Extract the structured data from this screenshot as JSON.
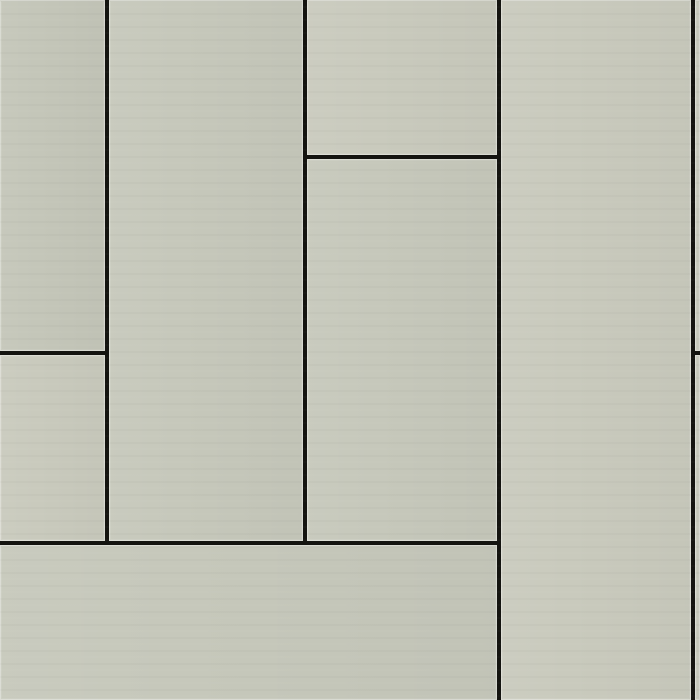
{
  "meta": {
    "description": "Seamless texture of smooth grey-green fiber-cement facade cladding planks laid vertically in a staggered running-bond pattern with thin dark open joints",
    "width": 700,
    "height": 700
  },
  "palette": {
    "seam": "#141410",
    "edge_highlight": "#d9dbd0",
    "panel_a": "#c4c6b9",
    "panel_b": "#c6c8bb",
    "panel_c": "#c9cabd"
  },
  "texture": {
    "seam_thickness": 4,
    "panels": [
      {
        "id": "panel-left-top",
        "x": 0,
        "y": 0,
        "w": 105,
        "h": 351,
        "shade": "panel_a"
      },
      {
        "id": "panel-left-lower",
        "x": 0,
        "y": 355,
        "w": 105,
        "h": 186,
        "shade": "panel_c"
      },
      {
        "id": "panel-col2-full",
        "x": 109,
        "y": 0,
        "w": 194,
        "h": 541,
        "shade": "panel_b"
      },
      {
        "id": "panel-col3-top",
        "x": 307,
        "y": 0,
        "w": 190,
        "h": 155,
        "shade": "panel_c"
      },
      {
        "id": "panel-col3-middle",
        "x": 307,
        "y": 159,
        "w": 190,
        "h": 382,
        "shade": "panel_b"
      },
      {
        "id": "panel-col4-full-height",
        "x": 501,
        "y": 0,
        "w": 190,
        "h": 700,
        "shade": "panel_c"
      },
      {
        "id": "panel-right-strip-top",
        "x": 695,
        "y": 0,
        "w": 5,
        "h": 351,
        "shade": "panel_b"
      },
      {
        "id": "panel-right-strip-lower",
        "x": 695,
        "y": 355,
        "w": 5,
        "h": 345,
        "shade": "panel_b"
      },
      {
        "id": "panel-bottom-wide",
        "x": 0,
        "y": 545,
        "w": 497,
        "h": 155,
        "shade": "panel_b"
      }
    ],
    "seams": [
      {
        "id": "seam-vertical-1",
        "orientation": "vertical",
        "x": 105,
        "y": 0,
        "length": 545
      },
      {
        "id": "seam-vertical-2",
        "orientation": "vertical",
        "x": 303,
        "y": 0,
        "length": 545
      },
      {
        "id": "seam-vertical-3",
        "orientation": "vertical",
        "x": 497,
        "y": 0,
        "length": 700
      },
      {
        "id": "seam-vertical-4",
        "orientation": "vertical",
        "x": 691,
        "y": 0,
        "length": 700
      },
      {
        "id": "seam-horizontal-col3",
        "orientation": "horizontal",
        "x": 303,
        "y": 155,
        "length": 198
      },
      {
        "id": "seam-horizontal-left",
        "orientation": "horizontal",
        "x": 0,
        "y": 351,
        "length": 109
      },
      {
        "id": "seam-horizontal-right",
        "orientation": "horizontal",
        "x": 691,
        "y": 351,
        "length": 9
      },
      {
        "id": "seam-horizontal-bottom",
        "orientation": "horizontal",
        "x": 0,
        "y": 541,
        "length": 501
      }
    ]
  }
}
